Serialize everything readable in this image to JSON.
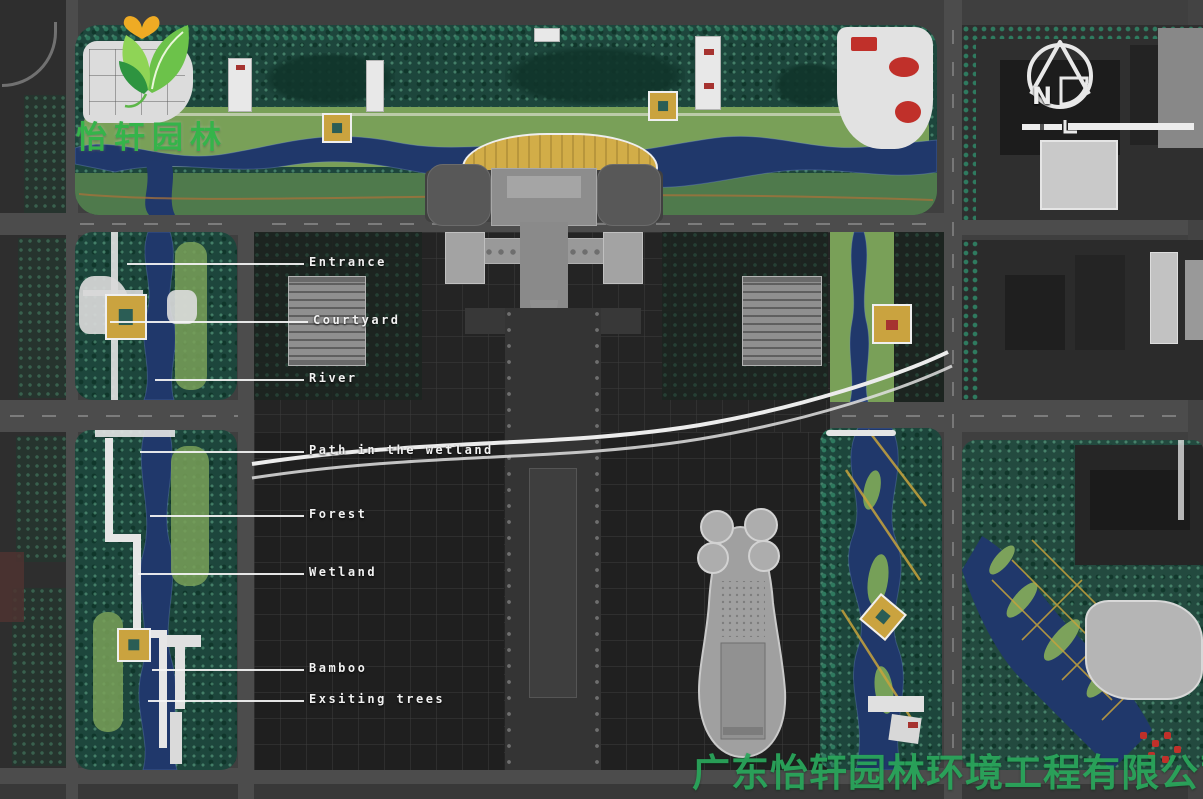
{
  "branding": {
    "logo_text": "怡轩园林",
    "watermark_text": "广东怡轩园林环境工程有限公司"
  },
  "compass": {
    "north_letter": "N"
  },
  "plan_labels": [
    {
      "text": "Entrance",
      "y": 263,
      "label_x": 309,
      "line_x1": 127
    },
    {
      "text": "Courtyard",
      "y": 321,
      "label_x": 313,
      "line_x1": 110
    },
    {
      "text": "River",
      "y": 379,
      "label_x": 309,
      "line_x1": 155
    },
    {
      "text": "Path in the wetland",
      "y": 451,
      "label_x": 309,
      "line_x1": 140
    },
    {
      "text": "Forest",
      "y": 515,
      "label_x": 309,
      "line_x1": 150
    },
    {
      "text": "Wetland",
      "y": 573,
      "label_x": 309,
      "line_x1": 138
    },
    {
      "text": "Bamboo",
      "y": 669,
      "label_x": 309,
      "line_x1": 152
    },
    {
      "text": "Exsiting trees",
      "y": 700,
      "label_x": 309,
      "line_x1": 148
    }
  ],
  "colors": {
    "road_gray": "#4c4c4c",
    "block_dark": "#262626",
    "tree_canopy": "#1d463c",
    "tree_speckle": "#3f8a6d",
    "lawn_green": "#79a058",
    "river_blue": "#20386b",
    "path_white": "#ececec",
    "arch_gold": "#d2ad48",
    "building_gray": "#9c9c9c",
    "accent_red": "#b23230",
    "accent_yellow": "#c8a33c",
    "label_white": "#f2f2f2",
    "logo_green": "#35b44a",
    "watermark_green": "#2aa45c"
  }
}
